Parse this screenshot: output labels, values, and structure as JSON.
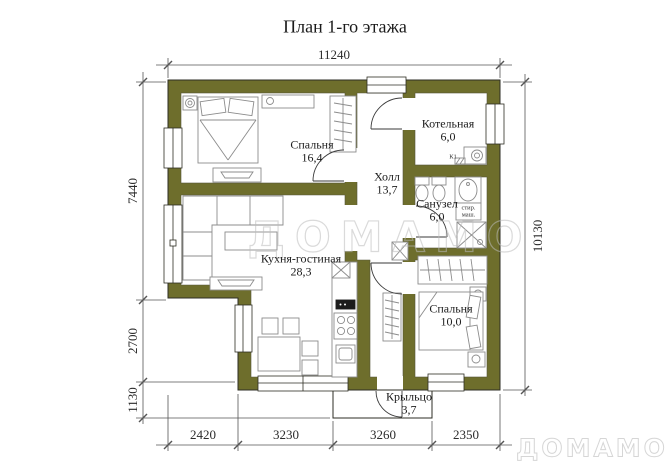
{
  "title": "План 1-го этажа",
  "watermarks": {
    "center": "ДОМАМО",
    "corner": "ДОМАМО"
  },
  "colors": {
    "wall": "#6e6e2c",
    "outline": "#2e2e24",
    "furniture": "#8c8c8c",
    "dim": "#555555",
    "text": "#1c1c1c"
  },
  "rooms": {
    "bedroom1": {
      "name": "Спальня",
      "area": "16,4"
    },
    "hall": {
      "name": "Холл",
      "area": "13,7"
    },
    "boiler": {
      "name": "Котельная",
      "area": "6,0"
    },
    "bathroom": {
      "name": "Санузел",
      "area": "6,0"
    },
    "kitchen_living": {
      "name": "Кухня-гостиная",
      "area": "28,3"
    },
    "bedroom2": {
      "name": "Спальня",
      "area": "10,0"
    },
    "porch": {
      "name": "Крыльцо",
      "area": "3,7"
    }
  },
  "annotations": {
    "boiler_unit": "К1",
    "washer_line1": "стир.",
    "washer_line2": "маш."
  },
  "dimensions": {
    "top": "11240",
    "right": "10130",
    "left_upper": "7440",
    "left_middle": "2700",
    "left_lower": "1130",
    "bottom_1": "2420",
    "bottom_2": "3230",
    "bottom_3": "3260",
    "bottom_4": "2350"
  }
}
